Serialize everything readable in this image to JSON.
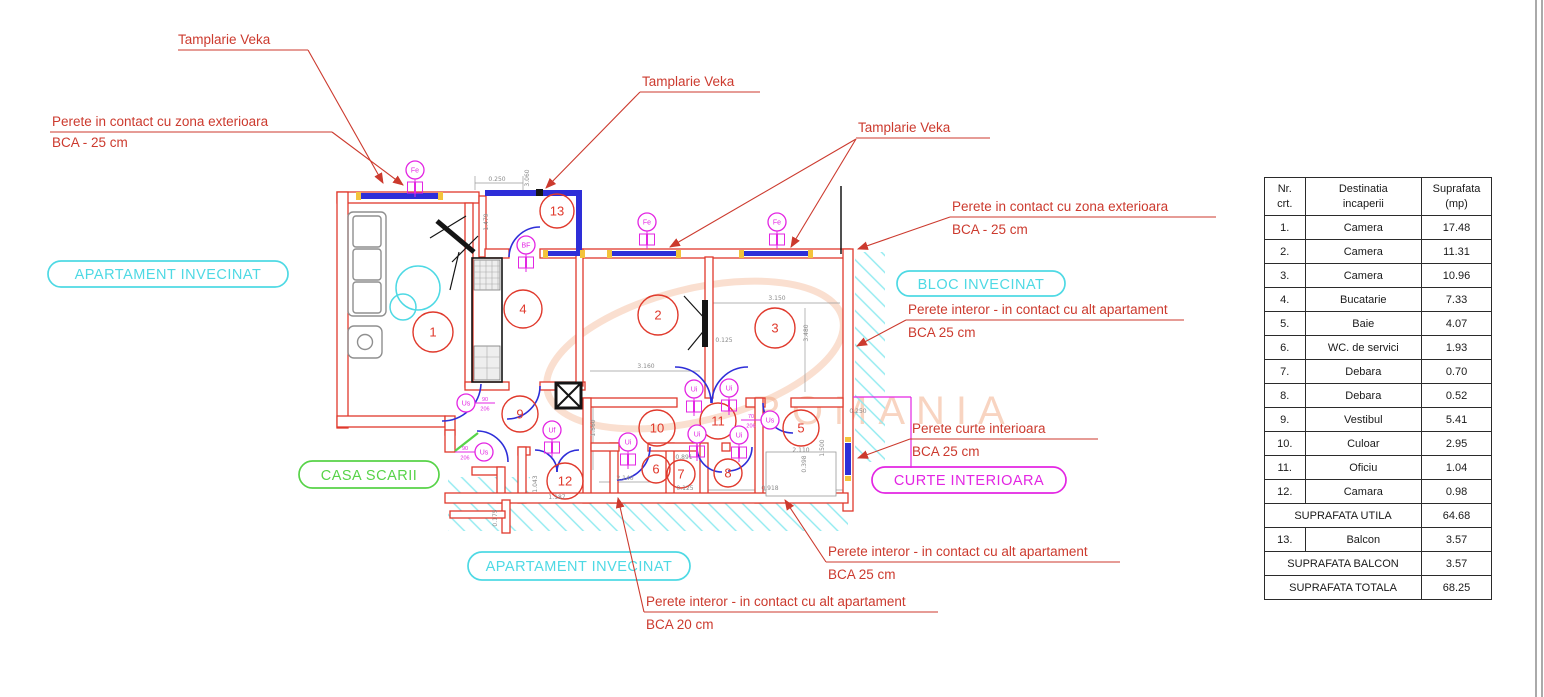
{
  "callouts": {
    "c1": {
      "l1": "Tamplarie Veka"
    },
    "c2": {
      "l1": "Perete in contact cu zona exterioara",
      "l2": "BCA - 25 cm"
    },
    "c3": {
      "l1": "Tamplarie Veka"
    },
    "c4": {
      "l1": "Tamplarie Veka"
    },
    "c5": {
      "l1": "Perete in contact cu zona exterioara",
      "l2": "BCA - 25 cm"
    },
    "c6": {
      "l1": "Perete interor - in contact cu alt apartament",
      "l2": "BCA 25 cm"
    },
    "c7": {
      "l1": "Perete curte interioara",
      "l2": "BCA 25 cm"
    },
    "c8": {
      "l1": "Perete interor - in contact cu alt apartament",
      "l2": "BCA 25 cm"
    },
    "c9": {
      "l1": "Perete interor - in contact cu alt apartament",
      "l2": "BCA 20 cm"
    }
  },
  "zones": {
    "apartament_invecinat_left": "APARTAMENT INVECINAT",
    "bloc_invecinat": "BLOC INVECINAT",
    "casa_scarii": "CASA SCARII",
    "curte_interioara": "CURTE INTERIOARA",
    "apartament_invecinat_bottom": "APARTAMENT INVECINAT"
  },
  "watermark": {
    "text": "ROMANIA"
  },
  "plan": {
    "rooms": [
      {
        "n": "1",
        "x": 433,
        "y": 332,
        "r": 20
      },
      {
        "n": "2",
        "x": 658,
        "y": 315,
        "r": 20
      },
      {
        "n": "3",
        "x": 775,
        "y": 328,
        "r": 20
      },
      {
        "n": "4",
        "x": 523,
        "y": 309,
        "r": 19
      },
      {
        "n": "5",
        "x": 801,
        "y": 428,
        "r": 18
      },
      {
        "n": "6",
        "x": 656,
        "y": 469,
        "r": 14
      },
      {
        "n": "7",
        "x": 681,
        "y": 474,
        "r": 14
      },
      {
        "n": "8",
        "x": 728,
        "y": 473,
        "r": 14
      },
      {
        "n": "9",
        "x": 520,
        "y": 414,
        "r": 18
      },
      {
        "n": "10",
        "x": 657,
        "y": 428,
        "r": 18
      },
      {
        "n": "11",
        "x": 718,
        "y": 421,
        "r": 18
      },
      {
        "n": "12",
        "x": 565,
        "y": 481,
        "r": 18
      },
      {
        "n": "13",
        "x": 557,
        "y": 211,
        "r": 17
      }
    ],
    "door_symbols": [
      {
        "t": "Fe",
        "x": 415,
        "y": 170,
        "boxes": true
      },
      {
        "t": "Fe",
        "x": 647,
        "y": 222,
        "boxes": true
      },
      {
        "t": "Fe",
        "x": 777,
        "y": 222,
        "boxes": true
      },
      {
        "t": "BF",
        "x": 526,
        "y": 245,
        "boxes": true
      },
      {
        "t": "Uf",
        "x": 552,
        "y": 430,
        "boxes": true
      },
      {
        "t": "Ui",
        "x": 628,
        "y": 442,
        "boxes": true
      },
      {
        "t": "Ui",
        "x": 694,
        "y": 389,
        "boxes": true
      },
      {
        "t": "Ui",
        "x": 729,
        "y": 388,
        "boxes": true
      },
      {
        "t": "Ui",
        "x": 697,
        "y": 434,
        "boxes": true
      },
      {
        "t": "Ui",
        "x": 739,
        "y": 435,
        "boxes": true
      },
      {
        "t": "Us",
        "x": 466,
        "y": 403,
        "frac": "90/206",
        "side": "r"
      },
      {
        "t": "Us",
        "x": 484,
        "y": 452,
        "frac": "90/206",
        "side": "l"
      },
      {
        "t": "Us",
        "x": 770,
        "y": 420,
        "frac": "70/206",
        "side": "l"
      }
    ],
    "dimensions": [
      {
        "t": "0.250",
        "x": 497,
        "y": 181,
        "r": 0
      },
      {
        "t": "3.060",
        "x": 529,
        "y": 178,
        "r": 90
      },
      {
        "t": "1.479",
        "x": 488,
        "y": 222,
        "r": 90
      },
      {
        "t": "3.150",
        "x": 777,
        "y": 300,
        "r": 0
      },
      {
        "t": "3.480",
        "x": 808,
        "y": 333,
        "r": 90
      },
      {
        "t": "0.125",
        "x": 724,
        "y": 342,
        "r": 0
      },
      {
        "t": "3.160",
        "x": 646,
        "y": 368,
        "r": 0
      },
      {
        "t": "1.560",
        "x": 595,
        "y": 428,
        "r": 90
      },
      {
        "t": "2.140",
        "x": 625,
        "y": 480,
        "r": 0
      },
      {
        "t": "0.891",
        "x": 684,
        "y": 459,
        "r": 0
      },
      {
        "t": "0.125",
        "x": 685,
        "y": 490,
        "r": 0
      },
      {
        "t": "0.918",
        "x": 770,
        "y": 490,
        "r": 0
      },
      {
        "t": "2.110",
        "x": 801,
        "y": 452,
        "r": 0
      },
      {
        "t": "1.500",
        "x": 824,
        "y": 448,
        "r": 90
      },
      {
        "t": "0.398",
        "x": 806,
        "y": 464,
        "r": 90
      },
      {
        "t": "0.250",
        "x": 858,
        "y": 413,
        "r": 0
      },
      {
        "t": "1.043",
        "x": 537,
        "y": 484,
        "r": 90
      },
      {
        "t": "1.187",
        "x": 557,
        "y": 499,
        "r": 0
      },
      {
        "t": "0.175",
        "x": 497,
        "y": 518,
        "r": 90
      }
    ]
  },
  "colors": {
    "wall_red": "#e0392c",
    "callout_red": "#cc3a2e",
    "window_blue": "#2e2ed8",
    "cyan": "#4ed9e4",
    "hatch_cyan": "#8feaf0",
    "green": "#57d348",
    "magenta": "#e326e3",
    "yellow": "#f3c33b",
    "watermark_orange": "#f09a6e"
  },
  "table": {
    "headers": [
      [
        "Nr.",
        "crt."
      ],
      [
        "Destinatia",
        "incaperii"
      ],
      [
        "Suprafata",
        "(mp)"
      ]
    ],
    "rows": [
      [
        "1.",
        "Camera",
        "17.48"
      ],
      [
        "2.",
        "Camera",
        "11.31"
      ],
      [
        "3.",
        "Camera",
        "10.96"
      ],
      [
        "4.",
        "Bucatarie",
        "7.33"
      ],
      [
        "5.",
        "Baie",
        "4.07"
      ],
      [
        "6.",
        "WC. de servici",
        "1.93"
      ],
      [
        "7.",
        "Debara",
        "0.70"
      ],
      [
        "8.",
        "Debara",
        "0.52"
      ],
      [
        "9.",
        "Vestibul",
        "5.41"
      ],
      [
        "10.",
        "Culoar",
        "2.95"
      ],
      [
        "11.",
        "Oficiu",
        "1.04"
      ],
      [
        "12.",
        "Camara",
        "0.98"
      ]
    ],
    "suprafata_utila": {
      "label": "SUPRAFATA UTILA",
      "value": "64.68"
    },
    "balcon_row": [
      "13.",
      "Balcon",
      "3.57"
    ],
    "suprafata_balcon": {
      "label": "SUPRAFATA BALCON",
      "value": "3.57"
    },
    "suprafata_totala": {
      "label": "SUPRAFATA TOTALA",
      "value": "68.25"
    }
  }
}
